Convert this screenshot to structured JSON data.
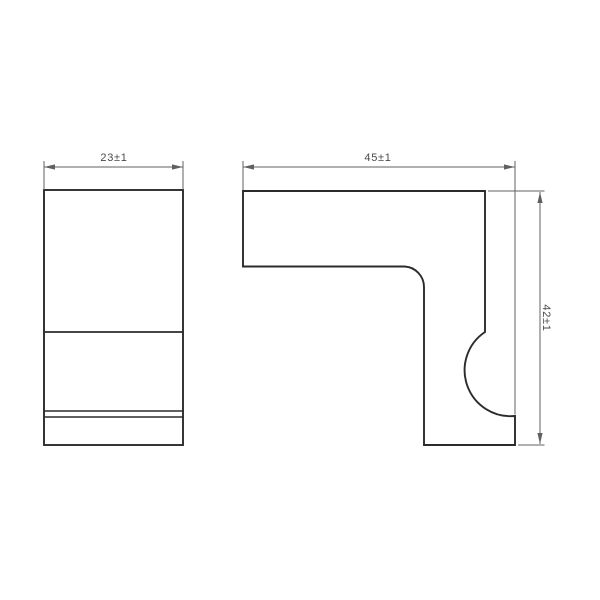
{
  "canvas": {
    "width": 600,
    "height": 600,
    "background": "#ffffff"
  },
  "colors": {
    "outline": "#2b2b2b",
    "thin_line": "#606060",
    "dimension_text": "#4a4a4a"
  },
  "dimensions": {
    "front_width": {
      "value": "23±1",
      "orientation": "horizontal"
    },
    "profile_width": {
      "value": "45±1",
      "orientation": "horizontal"
    },
    "profile_height": {
      "value": "42±1",
      "orientation": "vertical"
    }
  }
}
